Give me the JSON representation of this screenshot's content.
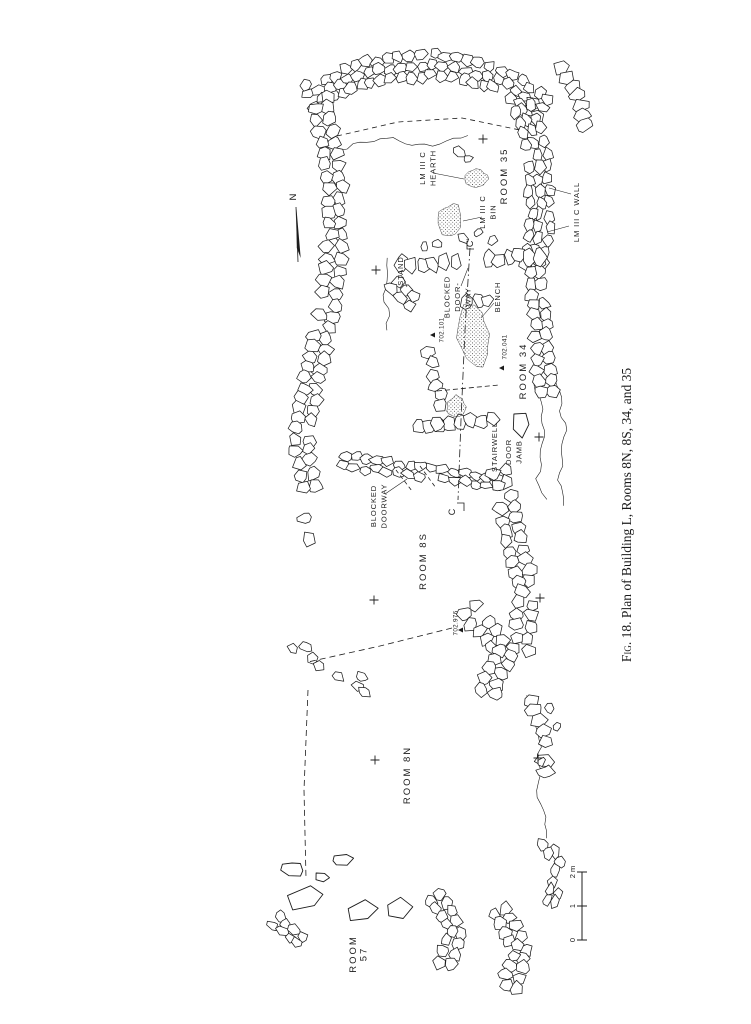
{
  "page": {
    "width": 751,
    "height": 1024,
    "background": "#ffffff",
    "ink": "#1c1c1c"
  },
  "figure": {
    "caption": {
      "label": "Fig. 18.",
      "title": "Plan of Building L, Rooms 8N, 8S, 34, and 35",
      "x": 627,
      "y": 515,
      "rotation": -90,
      "size": 13.5
    },
    "north_arrow": {
      "label": "N",
      "x": 293,
      "y": 197,
      "line": [
        [
          296,
          207
        ],
        [
          298,
          262
        ]
      ]
    },
    "scale_bar": {
      "x": 582,
      "top_y": 872,
      "bottom_y": 940,
      "unit": "m",
      "ticks": [
        {
          "label": "0",
          "y": 940
        },
        {
          "label": "1",
          "y": 906
        },
        {
          "label": "2 m",
          "y": 872
        }
      ]
    }
  },
  "labels": [
    {
      "id": "lm-iiic-hearth",
      "lines": [
        "LM III C",
        "HEARTH"
      ],
      "x": 427,
      "y": 168,
      "size": 7.5,
      "spacing": 0.9
    },
    {
      "id": "room-35",
      "lines": [
        "ROOM 35"
      ],
      "x": 504,
      "y": 176,
      "size": 9.5,
      "spacing": 2
    },
    {
      "id": "lm-iiic-bin",
      "lines": [
        "LM III C",
        "BIN"
      ],
      "x": 487,
      "y": 212,
      "size": 7.5,
      "spacing": 0.9
    },
    {
      "id": "lm-iiic-wall",
      "lines": [
        "LM III C WALL"
      ],
      "x": 576,
      "y": 212,
      "size": 7.5,
      "spacing": 0.9
    },
    {
      "id": "stand",
      "lines": [
        "STAND"
      ],
      "x": 400,
      "y": 271,
      "size": 7.5,
      "spacing": 0.9
    },
    {
      "id": "blocked-door-way-34",
      "lines": [
        "BLOCKED",
        "DOOR-",
        "WAY"
      ],
      "x": 457,
      "y": 297,
      "size": 7.5,
      "spacing": 0.9
    },
    {
      "id": "bench",
      "lines": [
        "BENCH"
      ],
      "x": 497,
      "y": 297,
      "size": 7.5,
      "spacing": 0.9
    },
    {
      "id": "room-34",
      "lines": [
        "ROOM 34"
      ],
      "x": 523,
      "y": 371,
      "size": 9.5,
      "spacing": 2
    },
    {
      "id": "stairwell",
      "lines": [
        "STAIRWELL"
      ],
      "x": 494,
      "y": 447,
      "size": 7.5,
      "spacing": 0.9
    },
    {
      "id": "door-jamb",
      "lines": [
        "DOOR",
        "JAMB"
      ],
      "x": 513,
      "y": 452,
      "size": 7.5,
      "spacing": 0.9
    },
    {
      "id": "blocked-doorway-8s",
      "lines": [
        "BLOCKED",
        "DOORWAY"
      ],
      "x": 378,
      "y": 506,
      "size": 7.5,
      "spacing": 0.9
    },
    {
      "id": "room-8s",
      "lines": [
        "ROOM 8S"
      ],
      "x": 423,
      "y": 561,
      "size": 9.5,
      "spacing": 2
    },
    {
      "id": "room-8n",
      "lines": [
        "ROOM 8N"
      ],
      "x": 407,
      "y": 775,
      "size": 9.5,
      "spacing": 2
    },
    {
      "id": "room-57",
      "lines": [
        "ROOM",
        "57"
      ],
      "x": 358,
      "y": 954,
      "size": 9.5,
      "spacing": 2
    }
  ],
  "section_markers": [
    {
      "label": "C",
      "x": 452,
      "y": 512,
      "bracket": [
        [
          457,
          503
        ],
        [
          464,
          503
        ],
        [
          464,
          511
        ]
      ]
    },
    {
      "label": "C'",
      "x": 470,
      "y": 243,
      "bracket": [
        [
          474,
          249
        ],
        [
          467,
          249
        ],
        [
          467,
          241
        ]
      ]
    }
  ],
  "elevation_markers": [
    {
      "value": "702.101",
      "tx": 441,
      "ty": 330,
      "mx": 433,
      "my": 335
    },
    {
      "value": "702.041",
      "tx": 504,
      "ty": 347,
      "mx": 502,
      "my": 368
    },
    {
      "value": "702.976",
      "tx": 455,
      "ty": 623,
      "mx": 461,
      "my": 630
    }
  ],
  "survey_crosses": [
    [
      376,
      270
    ],
    [
      483,
      139
    ],
    [
      539,
      437
    ],
    [
      374,
      600
    ],
    [
      540,
      598
    ],
    [
      375,
      760
    ],
    [
      538,
      758
    ]
  ],
  "plan": {
    "walls": [
      {
        "id": "north-end-wall",
        "path": [
          [
            310,
            95
          ],
          [
            368,
            72
          ],
          [
            432,
            64
          ],
          [
            498,
            78
          ],
          [
            543,
            108
          ]
        ],
        "w": 30
      },
      {
        "id": "west-wall",
        "path": [
          [
            320,
            98
          ],
          [
            332,
            165
          ],
          [
            336,
            235
          ],
          [
            328,
            305
          ],
          [
            312,
            378
          ],
          [
            300,
            450
          ],
          [
            310,
            487
          ]
        ],
        "w": 26
      },
      {
        "id": "lm-iiic-east-wall",
        "path": [
          [
            523,
            108
          ],
          [
            537,
            155
          ],
          [
            541,
            215
          ],
          [
            534,
            262
          ]
        ],
        "w": 28
      },
      {
        "id": "ne-fragment",
        "path": [
          [
            560,
            66
          ],
          [
            578,
            95
          ],
          [
            584,
            126
          ]
        ],
        "w": 16
      },
      {
        "id": "room34-east-wall",
        "path": [
          [
            534,
            262
          ],
          [
            541,
            325
          ],
          [
            546,
            392
          ]
        ],
        "w": 24
      },
      {
        "id": "room34-north-wall-w",
        "path": [
          [
            400,
            266
          ],
          [
            455,
            261
          ]
        ],
        "w": 15
      },
      {
        "id": "room34-north-wall-e",
        "path": [
          [
            489,
            259
          ],
          [
            540,
            256
          ]
        ],
        "w": 15
      },
      {
        "id": "stand-stones",
        "path": [
          [
            394,
            286
          ],
          [
            412,
            301
          ]
        ],
        "w": 22,
        "density": 0.9
      },
      {
        "id": "bench-stones",
        "path": [
          [
            458,
            305
          ],
          [
            488,
            300
          ]
        ],
        "w": 13
      },
      {
        "id": "stairwell-north-wall",
        "path": [
          [
            418,
            427
          ],
          [
            491,
            421
          ]
        ],
        "w": 13
      },
      {
        "id": "stairwell-south-wall",
        "path": [
          [
            344,
            460
          ],
          [
            420,
            473
          ],
          [
            498,
            482
          ]
        ],
        "w": 17
      },
      {
        "id": "room34-west-stones",
        "path": [
          [
            428,
            352
          ],
          [
            440,
            395
          ],
          [
            437,
            424
          ]
        ],
        "w": 13,
        "density": 0.7
      },
      {
        "id": "room8s-east-wall",
        "path": [
          [
            500,
            473
          ],
          [
            512,
            530
          ],
          [
            527,
            592
          ],
          [
            520,
            650
          ]
        ],
        "w": 26
      },
      {
        "id": "divider-8s-8n",
        "path": [
          [
            470,
            612
          ],
          [
            505,
            652
          ],
          [
            488,
            692
          ]
        ],
        "w": 26
      },
      {
        "id": "divider-west-scatter",
        "path": [
          [
            295,
            645
          ],
          [
            330,
            668
          ],
          [
            368,
            688
          ]
        ],
        "w": 18,
        "density": 0.55
      },
      {
        "id": "west-frag-8s",
        "path": [
          [
            303,
            505
          ],
          [
            309,
            540
          ],
          [
            303,
            565
          ]
        ],
        "w": 13,
        "density": 0.6
      },
      {
        "id": "room8n-east-stones",
        "path": [
          [
            532,
            700
          ],
          [
            545,
            742
          ],
          [
            543,
            782
          ]
        ],
        "w": 15,
        "density": 0.65
      },
      {
        "id": "east-stones-lower",
        "path": [
          [
            546,
            843
          ],
          [
            560,
            874
          ],
          [
            551,
            902
          ]
        ],
        "w": 17,
        "density": 0.85
      },
      {
        "id": "room57-east-cluster",
        "path": [
          [
            437,
            897
          ],
          [
            456,
            932
          ],
          [
            446,
            963
          ]
        ],
        "w": 22
      },
      {
        "id": "room57-se-cluster",
        "path": [
          [
            500,
            913
          ],
          [
            521,
            948
          ],
          [
            511,
            986
          ]
        ],
        "w": 24
      },
      {
        "id": "room57-west-cluster",
        "path": [
          [
            276,
            922
          ],
          [
            300,
            940
          ]
        ],
        "w": 18
      }
    ],
    "slabs": [
      [
        307,
        899,
        19,
        12,
        -0.3
      ],
      [
        293,
        869,
        12,
        8,
        0.1
      ],
      [
        322,
        877,
        8,
        5,
        0
      ],
      [
        361,
        911,
        18,
        11,
        -0.25
      ],
      [
        398,
        909,
        15,
        10,
        -0.2
      ],
      [
        341,
        860,
        11,
        6,
        -0.2
      ],
      [
        521,
        424,
        10,
        13,
        0.05
      ]
    ],
    "singles": [
      [
        463,
        238,
        6
      ],
      [
        478,
        233,
        5
      ],
      [
        493,
        240,
        6
      ],
      [
        459,
        152,
        7
      ],
      [
        468,
        159,
        5
      ],
      [
        549,
        708,
        6
      ],
      [
        557,
        727,
        5
      ],
      [
        541,
        762,
        5
      ],
      [
        424,
        247,
        5
      ],
      [
        437,
        244,
        5
      ]
    ],
    "blobs": [
      {
        "id": "hearth-fill",
        "x": 476,
        "y": 179,
        "rx": 11,
        "ry": 9,
        "rot": 0
      },
      {
        "id": "bin-fill",
        "x": 450,
        "y": 220,
        "rx": 12,
        "ry": 16,
        "rot": 0.2
      },
      {
        "id": "bench-fill",
        "x": 473,
        "y": 336,
        "rx": 15,
        "ry": 30,
        "rot": -0.12
      },
      {
        "id": "stairwell-fill",
        "x": 456,
        "y": 407,
        "rx": 9,
        "ry": 11,
        "rot": 0
      }
    ],
    "wavy": [
      {
        "path": [
          [
            388,
            258
          ],
          [
            384,
            295
          ],
          [
            389,
            330
          ]
        ]
      },
      {
        "path": [
          [
            536,
            382
          ],
          [
            545,
            430
          ],
          [
            538,
            478
          ],
          [
            545,
            500
          ]
        ]
      },
      {
        "path": [
          [
            556,
            378
          ],
          [
            566,
            430
          ],
          [
            558,
            480
          ],
          [
            566,
            505
          ]
        ]
      },
      {
        "path": [
          [
            340,
            148
          ],
          [
            380,
            138
          ],
          [
            425,
            146
          ],
          [
            468,
            136
          ]
        ]
      },
      {
        "path": [
          [
            528,
            695
          ],
          [
            540,
            740
          ],
          [
            538,
            790
          ],
          [
            548,
            838
          ]
        ]
      }
    ],
    "dashed": [
      {
        "id": "section-line-c",
        "path": [
          [
            470,
            248
          ],
          [
            465,
            330
          ],
          [
            461,
            420
          ],
          [
            458,
            500
          ]
        ],
        "dash": "8 3 1.5 3"
      },
      {
        "id": "room35-inner",
        "path": [
          [
            337,
            136
          ],
          [
            398,
            122
          ],
          [
            462,
            118
          ],
          [
            520,
            130
          ]
        ],
        "dash": "5 4"
      },
      {
        "id": "stairwell-top",
        "path": [
          [
            437,
            391
          ],
          [
            499,
            385
          ]
        ],
        "dash": "5 3"
      },
      {
        "id": "blocked-8s-a",
        "path": [
          [
            396,
            470
          ],
          [
            412,
            491
          ]
        ],
        "dash": "4 3"
      },
      {
        "id": "blocked-8s-b",
        "path": [
          [
            420,
            466
          ],
          [
            436,
            488
          ]
        ],
        "dash": "4 3"
      },
      {
        "id": "divider-robbed",
        "path": [
          [
            452,
            628
          ],
          [
            380,
            646
          ],
          [
            308,
            662
          ]
        ],
        "dash": "6 4"
      },
      {
        "id": "west-robbed",
        "path": [
          [
            308,
            690
          ],
          [
            304,
            790
          ],
          [
            306,
            878
          ]
        ],
        "dash": "6 4"
      }
    ],
    "leaders": [
      [
        [
          433,
          173
        ],
        [
          464,
          179
        ]
      ],
      [
        [
          482,
          217
        ],
        [
          463,
          221
        ]
      ],
      [
        [
          571,
          194
        ],
        [
          549,
          188
        ]
      ],
      [
        [
          569,
          226
        ],
        [
          547,
          232
        ]
      ],
      [
        [
          494,
          303
        ],
        [
          481,
          318
        ]
      ],
      [
        [
          461,
          286
        ],
        [
          468,
          268
        ]
      ],
      [
        [
          385,
          494
        ],
        [
          407,
          479
        ]
      ],
      [
        [
          403,
          277
        ],
        [
          407,
          287
        ]
      ]
    ]
  }
}
